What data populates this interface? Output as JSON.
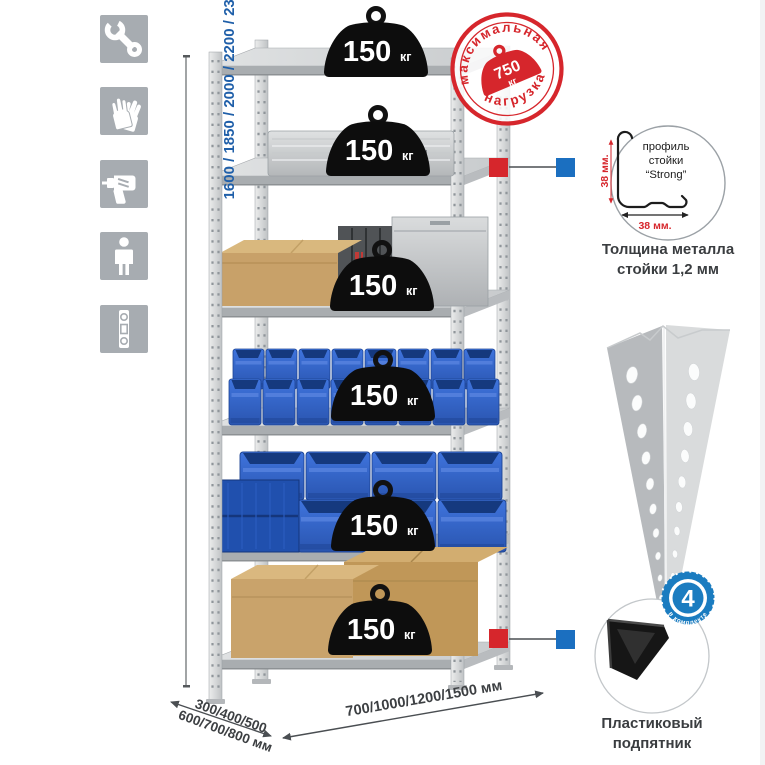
{
  "sidebar_icons": [
    "wrench",
    "work-gloves",
    "drill",
    "person",
    "spirit-level"
  ],
  "dimensions": {
    "height_label": "1600 / 1850 / 2000 / 2200 / 2350 / 2550 / 2750 / 3100 мм",
    "depth_line1": "300/400/500",
    "depth_line2": "600/700/800 мм",
    "width_label": "700/1000/1200/1500 мм"
  },
  "stamp": {
    "arc_top": "максимальная",
    "arc_bottom": "нагрузка",
    "value": "750",
    "unit": "кг"
  },
  "rack": {
    "shelves": [
      {
        "load": "150",
        "unit": "кг"
      },
      {
        "load": "150",
        "unit": "кг"
      },
      {
        "load": "150",
        "unit": "кг"
      },
      {
        "load": "150",
        "unit": "кг"
      },
      {
        "load": "150",
        "unit": "кг"
      },
      {
        "load": "150",
        "unit": "кг"
      }
    ]
  },
  "profile_detail": {
    "line1": "профиль",
    "line2": "стойки",
    "line3": "“Strong”",
    "dim_vertical": "38 мм.",
    "dim_horizontal": "38 мм.",
    "caption_line1": "Толщина металла",
    "caption_line2": "стойки 1,2 мм"
  },
  "foot_detail": {
    "badge_value": "4",
    "badge_arc": "в комплекте",
    "caption_line1": "Пластиковый",
    "caption_line2": "подпятник"
  },
  "colors": {
    "accent_red": "#d6262c",
    "accent_blue": "#1b6fc0",
    "dimension_blue": "#1f5fa9",
    "bin_blue": "#2f62c4",
    "icon_gray": "#a7acb1"
  }
}
